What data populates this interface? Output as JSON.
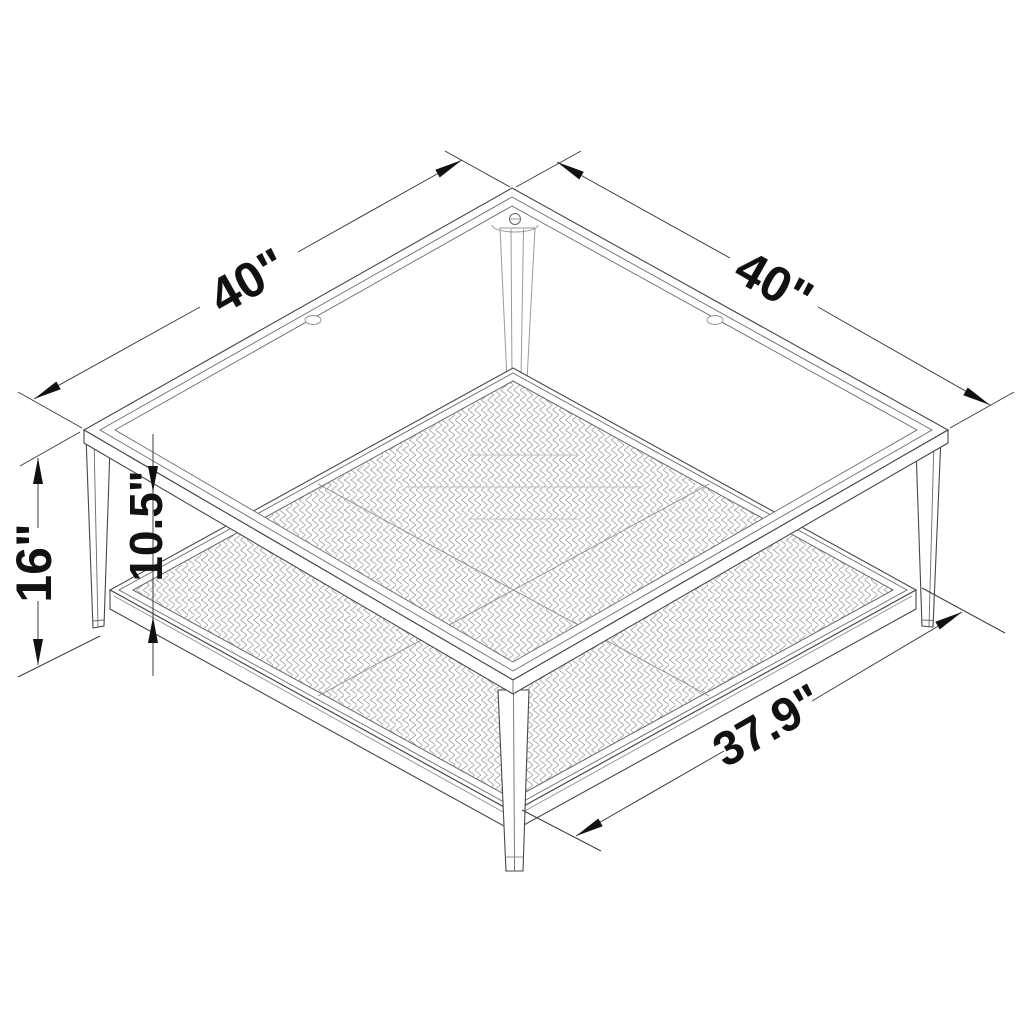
{
  "page": {
    "background": "#ffffff",
    "kind": "furniture dimension line drawing",
    "subject": "square coffee table with glass top, four tapered legs and woven lower shelf"
  },
  "annotations": {
    "top_left_width": {
      "label": "40\"",
      "value": 40,
      "unit": "inches",
      "edge": "glass top left edge"
    },
    "top_right_depth": {
      "label": "40\"",
      "value": 40,
      "unit": "inches",
      "edge": "glass top right edge"
    },
    "overall_height": {
      "label": "16\"",
      "value": 16,
      "unit": "inches",
      "edge": "floor to glass top"
    },
    "shelf_clearance": {
      "label": "10.5\"",
      "value": 10.5,
      "unit": "inches",
      "edge": "underside of glass to shelf surface"
    },
    "shelf_width": {
      "label": "37.9\"",
      "value": 37.9,
      "unit": "inches",
      "edge": "lower shelf front edge"
    }
  },
  "style": {
    "outline_color": "#474747",
    "dimension_line_color": "#3d3d3d",
    "arrow_color": "#111111",
    "text_color": "#111111",
    "mesh_color": "#a9a9a9",
    "glass_reflection_color": "#c2c2c2"
  }
}
